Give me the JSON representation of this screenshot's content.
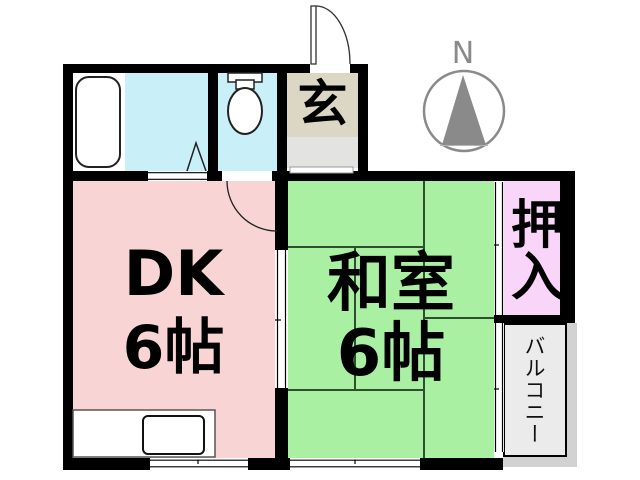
{
  "floorplan": {
    "compass": {
      "label": "N",
      "color": "#8a8a8a"
    },
    "rooms": {
      "dk": {
        "label": "DK",
        "size": "6帖",
        "color": "#f9d4d4"
      },
      "washitsu": {
        "label": "和室",
        "size": "6帖",
        "color": "#a9f0a2"
      },
      "genkan": {
        "label": "玄",
        "color": "#dcd7c5",
        "step_color": "#e3e3e1"
      },
      "oshiire": {
        "label": "押入",
        "color": "#f9d6f9"
      },
      "balcony": {
        "label": "バルコニー",
        "color": "#ebebeb"
      },
      "bathroom": {
        "color": "#c9eff8"
      },
      "toilet_room": {
        "color": "#c9eff8"
      }
    },
    "fixtures": {
      "bathtub": "bathtub-icon",
      "toilet": "toilet-icon",
      "kitchen_sink": "kitchen-sink-icon",
      "folding_door": "folding-door-icon",
      "entrance_door": "entrance-door-swing-icon",
      "toilet_door": "toilet-door-swing-icon"
    },
    "wall_color": "#000000",
    "tatami_line_color": "#2e4f2e"
  }
}
